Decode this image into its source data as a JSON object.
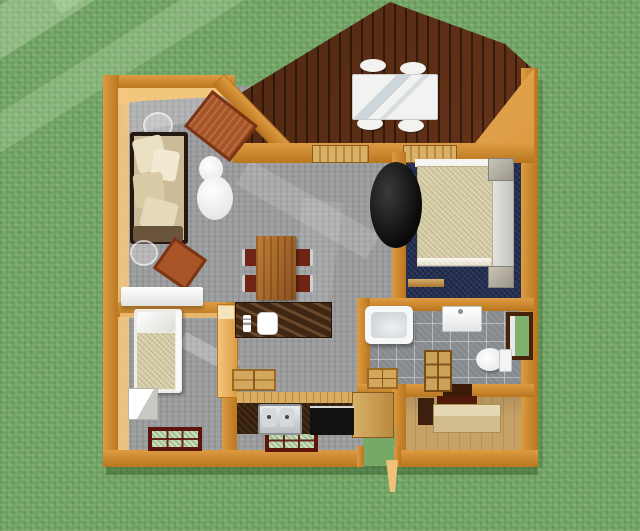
{
  "scene": {
    "title": "Overhead 3D rendering of a small cabin floor plan on a grass lawn",
    "view": "top-down 3D floor plan",
    "rooms": [
      {
        "name": "deck",
        "floor": "dark wood planks",
        "shape": "gabled point at top"
      },
      {
        "name": "living-room",
        "floor": "gray carpet"
      },
      {
        "name": "dining-area",
        "floor": "gray carpet"
      },
      {
        "name": "bedroom",
        "floor": "navy carpet"
      },
      {
        "name": "small-bedroom",
        "floor": "gray carpet"
      },
      {
        "name": "kitchen",
        "floor": "gray carpet"
      },
      {
        "name": "bathroom",
        "floor": "gray tile"
      },
      {
        "name": "utility-room",
        "floor": "tan wood"
      }
    ],
    "furniture": [
      "deck patio table with four white chairs",
      "sofa with cream cushions against left wall",
      "two copper area rugs",
      "white floor lamp",
      "two round glass side tables",
      "white console table",
      "wood dining table with four red-seat chairs",
      "kitchen island with dark marble top and white sink",
      "tall wood pantry cabinet",
      "kitchen counter with double steel sink and black cooktop",
      "single bed with tan blanket and white dresser",
      "double bed with cream blanket and two gray nightstands",
      "black wood stove",
      "low wood bench in bedroom",
      "bathtub, vanity sink, toilet, wood shelf, wood bath mat",
      "utility room dresser",
      "two wood floor grates",
      "two bottom-wall windows with dark red frames",
      "side window with dark brown frame"
    ],
    "palette": {
      "grass": "#76a868",
      "wall": "#dd9b42",
      "wall_dark": "#b9761f",
      "wall_light": "#f3c67e",
      "deck": "#5e2f16",
      "deck_dark": "#48240e",
      "floor": "#9b9c9e",
      "floor_light": "#c7c8ca",
      "navy": "#283459",
      "tile": "#8d9094",
      "utility": "#c6a267",
      "marble": "#3f2713",
      "counter": "#32200f",
      "counter_top": "#d9ae62",
      "wood": "#a9682c",
      "rug": "#a85426",
      "white": "#f2f2f0",
      "cream": "#e6ddbd",
      "blanket": "#d8cfa8",
      "window_red": "#5c150a",
      "window_brown": "#46220a",
      "steel": "#c9cdd1",
      "black": "#111111"
    }
  }
}
